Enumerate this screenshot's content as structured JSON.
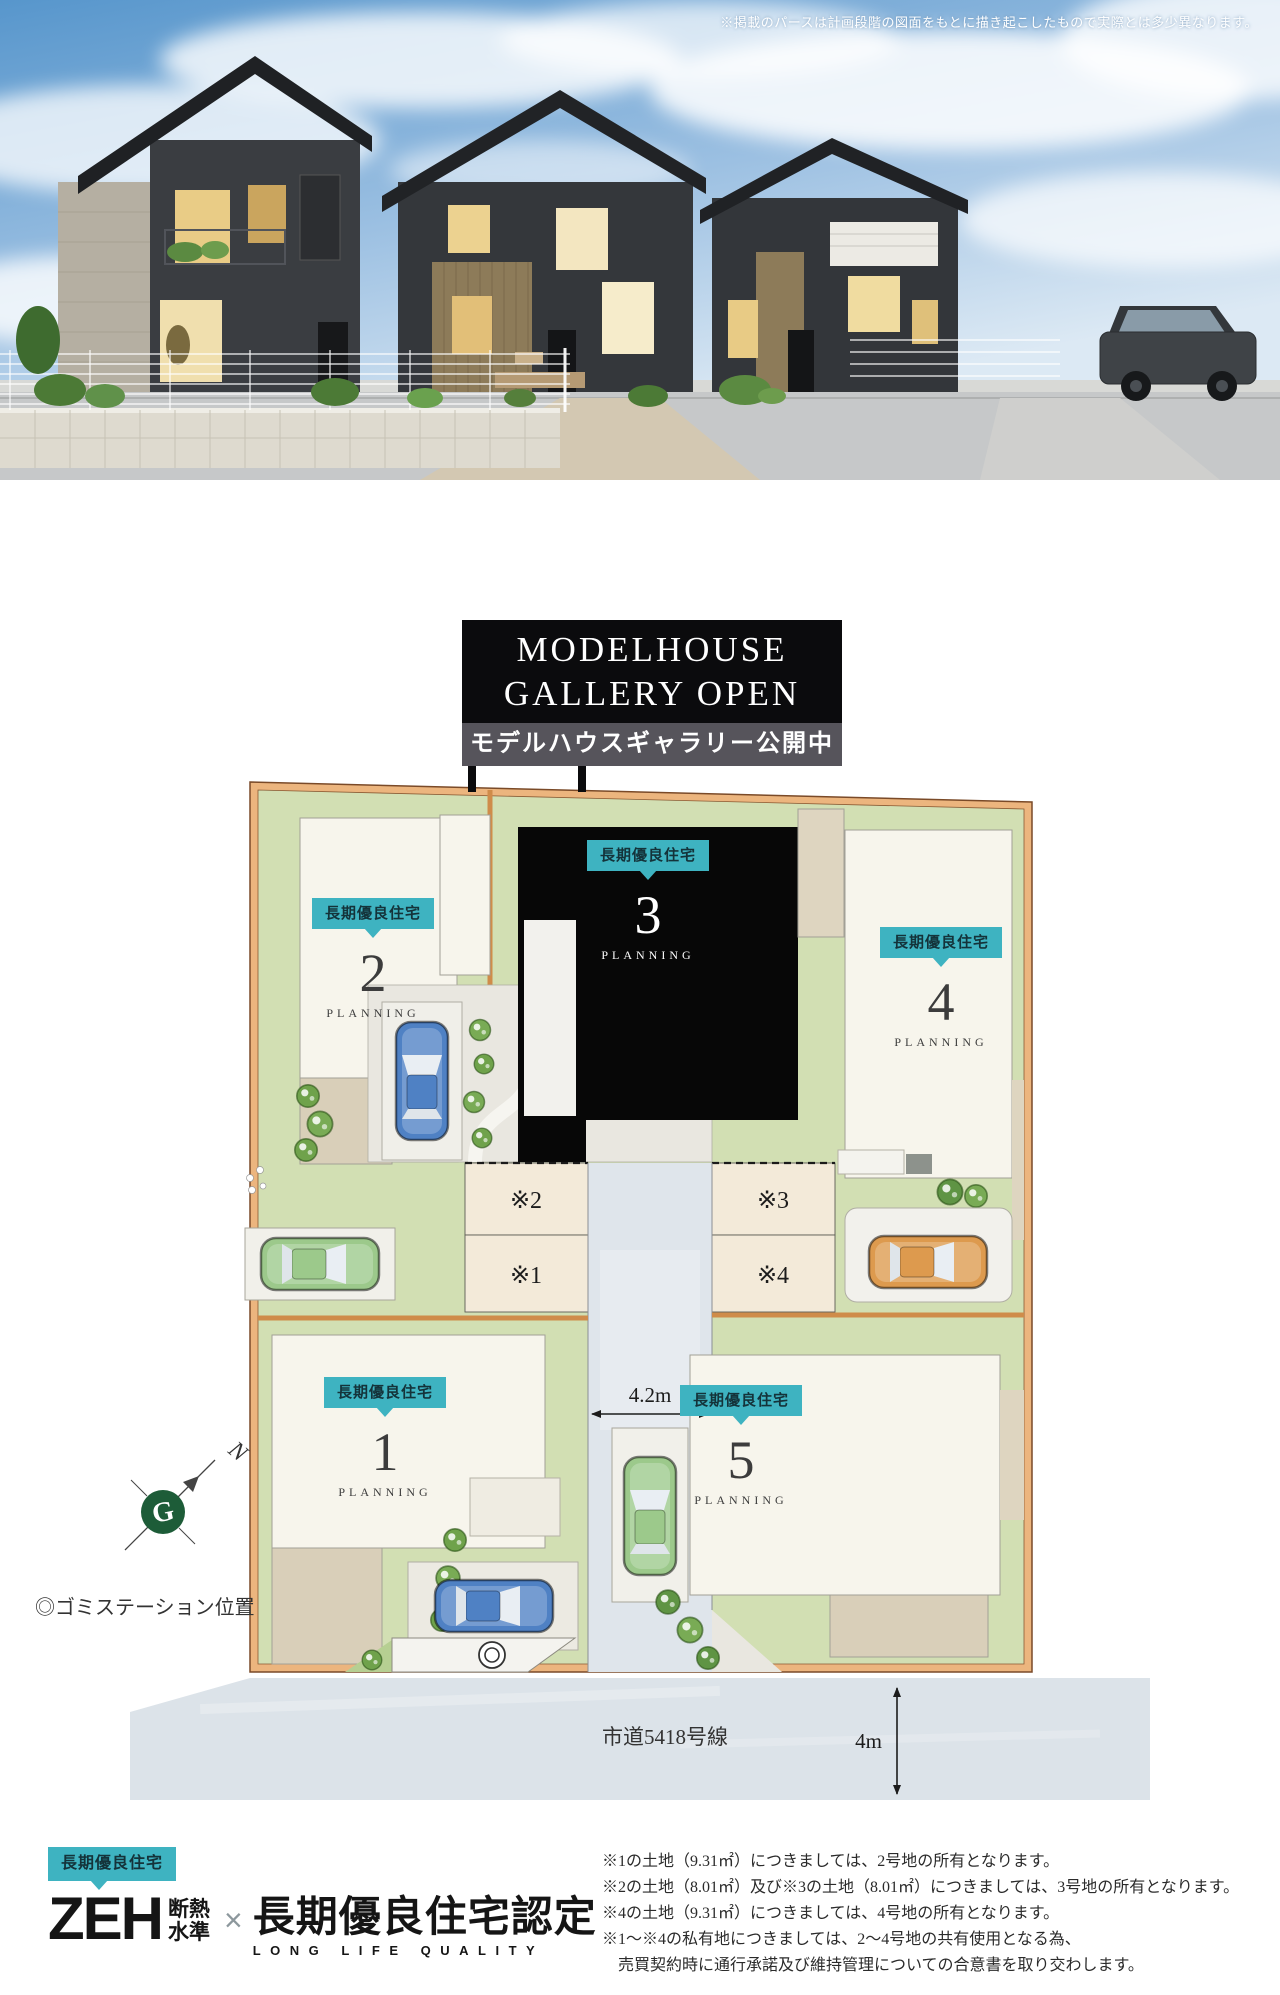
{
  "hero": {
    "disclaimer": "※掲載のパースは計画段階の図面をもとに描き起こしたもので実際とは多少異なります。"
  },
  "banner": {
    "title_line1": "MODELHOUSE",
    "title_line2": "GALLERY OPEN",
    "subtitle": "モデルハウスギャラリー公開中"
  },
  "site_plan": {
    "lots": [
      {
        "badge": "長期優良住宅",
        "number": "1",
        "planning": "PLANNING"
      },
      {
        "badge": "長期優良住宅",
        "number": "2",
        "planning": "PLANNING"
      },
      {
        "badge": "長期優良住宅",
        "number": "3",
        "planning": "PLANNING"
      },
      {
        "badge": "長期優良住宅",
        "number": "4",
        "planning": "PLANNING"
      },
      {
        "badge": "長期優良住宅",
        "number": "5",
        "planning": "PLANNING"
      }
    ],
    "shared": {
      "s1": "※1",
      "s2": "※2",
      "s3": "※3",
      "s4": "※4"
    },
    "dimensions": {
      "road_width": "4.2m",
      "road_depth": "4m"
    },
    "road_name": "市道5418号線",
    "garbage_note": "◎ゴミステーション位置",
    "compass": {
      "n": "N",
      "g": "G"
    }
  },
  "footer": {
    "badge_label": "長期優良住宅",
    "zeh": "ZEH",
    "zeh_sub1": "断熱",
    "zeh_sub2": "水準",
    "multiply": "×",
    "cert": "長期優良住宅認定",
    "cert_sub": "LONG LIFE QUALITY",
    "notes": [
      "※1の土地（9.31㎡）につきましては、2号地の所有となります。",
      "※2の土地（8.01㎡）及び※3の土地（8.01㎡）につきましては、3号地の所有となります。",
      "※4の土地（9.31㎡）につきましては、4号地の所有となります。",
      "※1～※4の私有地につきましては、2～4号地の共有使用となる為、",
      "　売買契約時に通行承諾及び維持管理についての合意書を取り交わします。"
    ]
  },
  "colors": {
    "accent_teal": "#3eb3c1",
    "plan_green": "#d2dfb3",
    "plan_border_orange": "#ecb57e",
    "model_lot_black": "#070707",
    "road_gray": "#dfe5eb"
  }
}
